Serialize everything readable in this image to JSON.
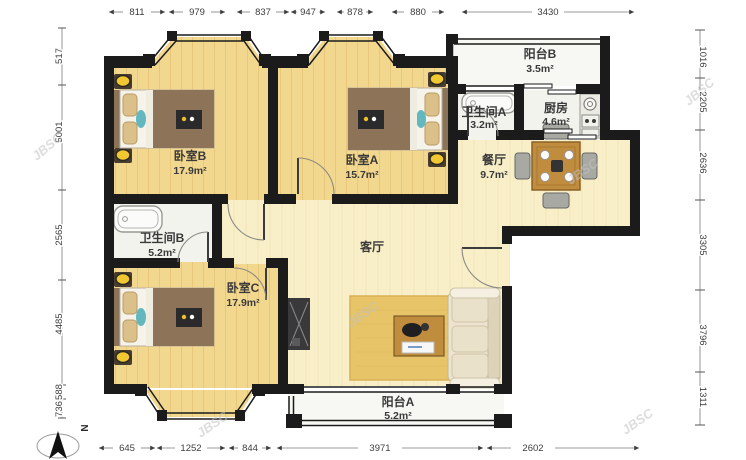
{
  "page": {
    "type": "apartment-floor-plan"
  },
  "watermark": {
    "text": "JBSC"
  },
  "compass": {
    "north_label": "N"
  },
  "colors": {
    "wall": "#1b1b1b",
    "bedroom_floor": "#f2d78e",
    "living_floor": "#f8efc9",
    "wet_floor": "#f3f3ee",
    "rug": "#e7c467",
    "wood_accent": "#c08c3e",
    "lamp": "#f2c832"
  },
  "rooms": [
    {
      "id": "bedroom-b",
      "name": "卧室B",
      "area": "17.9m²"
    },
    {
      "id": "bedroom-a",
      "name": "卧室A",
      "area": "15.7m²"
    },
    {
      "id": "balcony-b",
      "name": "阳台B",
      "area": "3.5m²"
    },
    {
      "id": "bath-a",
      "name": "卫生间A",
      "area": "3.2m²"
    },
    {
      "id": "kitchen",
      "name": "厨房",
      "area": "4.6m²"
    },
    {
      "id": "dining",
      "name": "餐厅",
      "area": "9.7m²"
    },
    {
      "id": "bath-b",
      "name": "卫生间B",
      "area": "5.2m²"
    },
    {
      "id": "bedroom-c",
      "name": "卧室C",
      "area": "17.9m²"
    },
    {
      "id": "living",
      "name": "客厅",
      "area": ""
    },
    {
      "id": "balcony-a",
      "name": "阳台A",
      "area": "5.2m²"
    }
  ],
  "dimensions": {
    "top": [
      "811",
      "979",
      "837",
      "947",
      "878",
      "880",
      "3430"
    ],
    "bottom": [
      "645",
      "1252",
      "844",
      "3971",
      "2602"
    ],
    "left": [
      "517",
      "5001",
      "2565",
      "4485",
      "588",
      "736"
    ],
    "right": [
      "1016",
      "2205",
      "2636",
      "3305",
      "3796",
      "1311"
    ]
  }
}
